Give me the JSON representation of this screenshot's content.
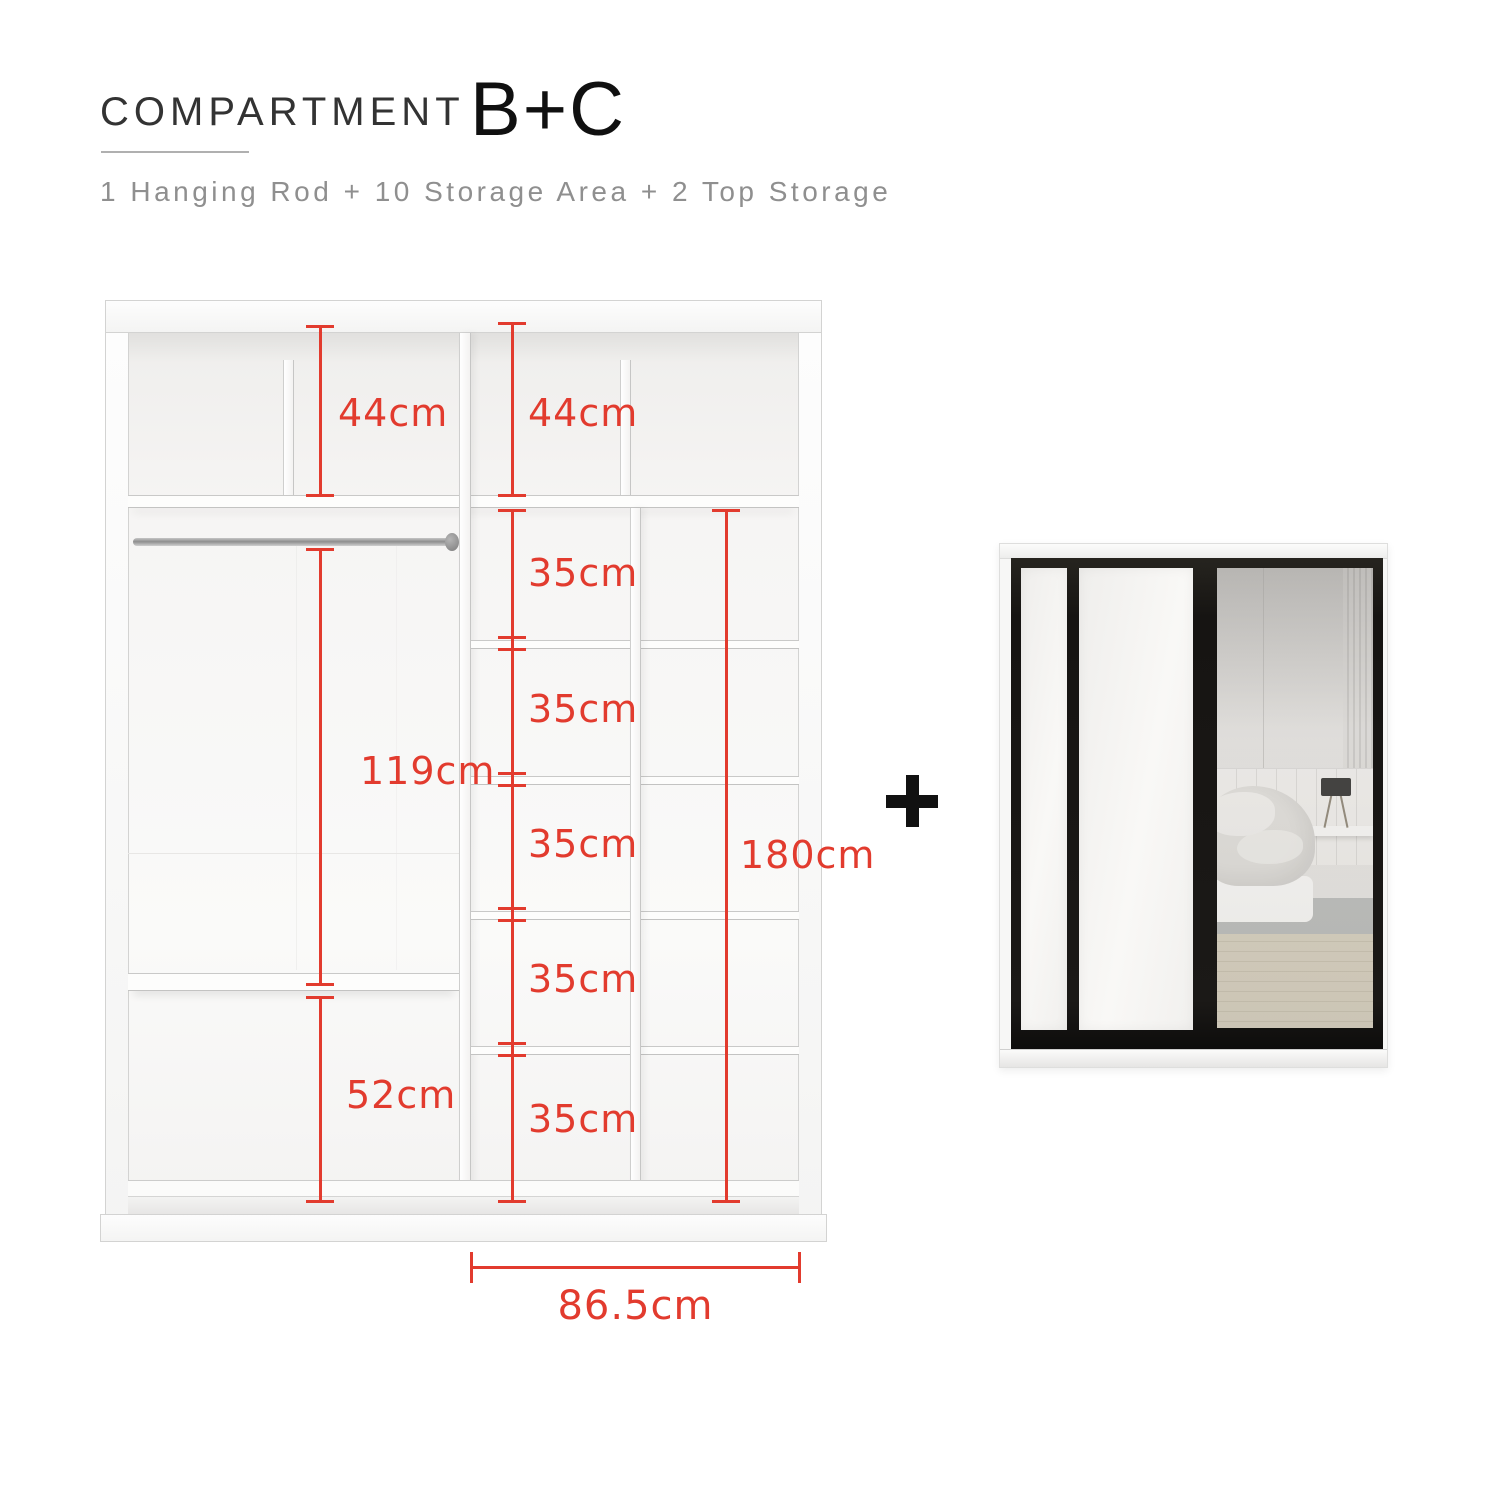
{
  "header": {
    "title": "COMPARTMENT",
    "variant": "B+C",
    "subtitle": "1 Hanging Rod + 10 Storage Area + 2 Top Storage"
  },
  "diagram": {
    "top_left_height": "44cm",
    "top_right_height": "44cm",
    "hanging_height": "119cm",
    "left_bottom_height": "52cm",
    "cell_heights": [
      "35cm",
      "35cm",
      "35cm",
      "35cm",
      "35cm"
    ],
    "right_column_height": "180cm",
    "section_width": "86.5cm"
  },
  "separator": {
    "plus": "+"
  },
  "colors": {
    "dimension_red": "#e23b2e",
    "door_frame_black": "#161412"
  }
}
